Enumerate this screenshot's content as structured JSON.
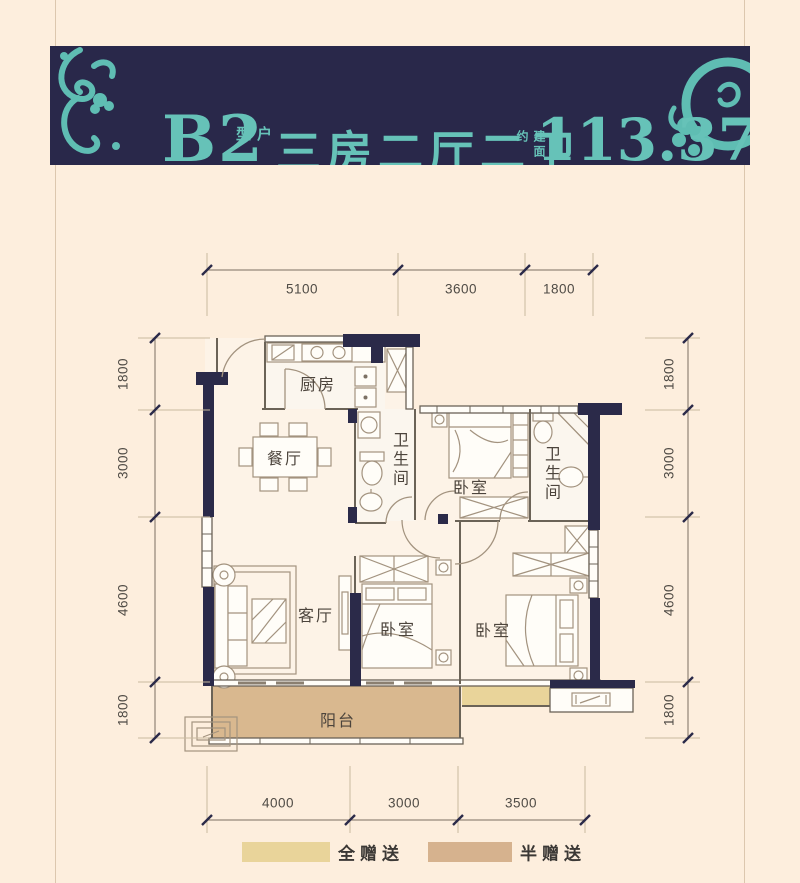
{
  "background": "#fdeedd",
  "header": {
    "unit_code": "B2",
    "unit_type_label": "户型",
    "layout_text": "三房二厅二卫",
    "area_prefix": "建面约",
    "area_value": "113.37m",
    "area_sup": "2",
    "bg_color": "#29284a",
    "accent_color": "#66c2b8"
  },
  "plan": {
    "wall_color": "#2b2a49",
    "line_color": "#a3937f",
    "balcony_fill": "#d9b88f",
    "gift_full_fill": "#e9d49a",
    "rooms": [
      {
        "label": "厨房"
      },
      {
        "label": "餐厅"
      },
      {
        "label": "卫生间"
      },
      {
        "label": "卧室"
      },
      {
        "label": "卫生间"
      },
      {
        "label": "客厅"
      },
      {
        "label": "卧室"
      },
      {
        "label": "卧室"
      },
      {
        "label": "阳台"
      }
    ],
    "dimensions": {
      "top": [
        "5100",
        "3600",
        "1800"
      ],
      "bottom": [
        "4000",
        "3000",
        "3500"
      ],
      "left": [
        "1800",
        "3000",
        "4600",
        "1800"
      ],
      "right": [
        "1800",
        "3000",
        "4600",
        "1800"
      ]
    }
  },
  "legend": [
    {
      "label": "全赠送",
      "color": "#e9d49a"
    },
    {
      "label": "半赠送",
      "color": "#d6b28e"
    }
  ]
}
